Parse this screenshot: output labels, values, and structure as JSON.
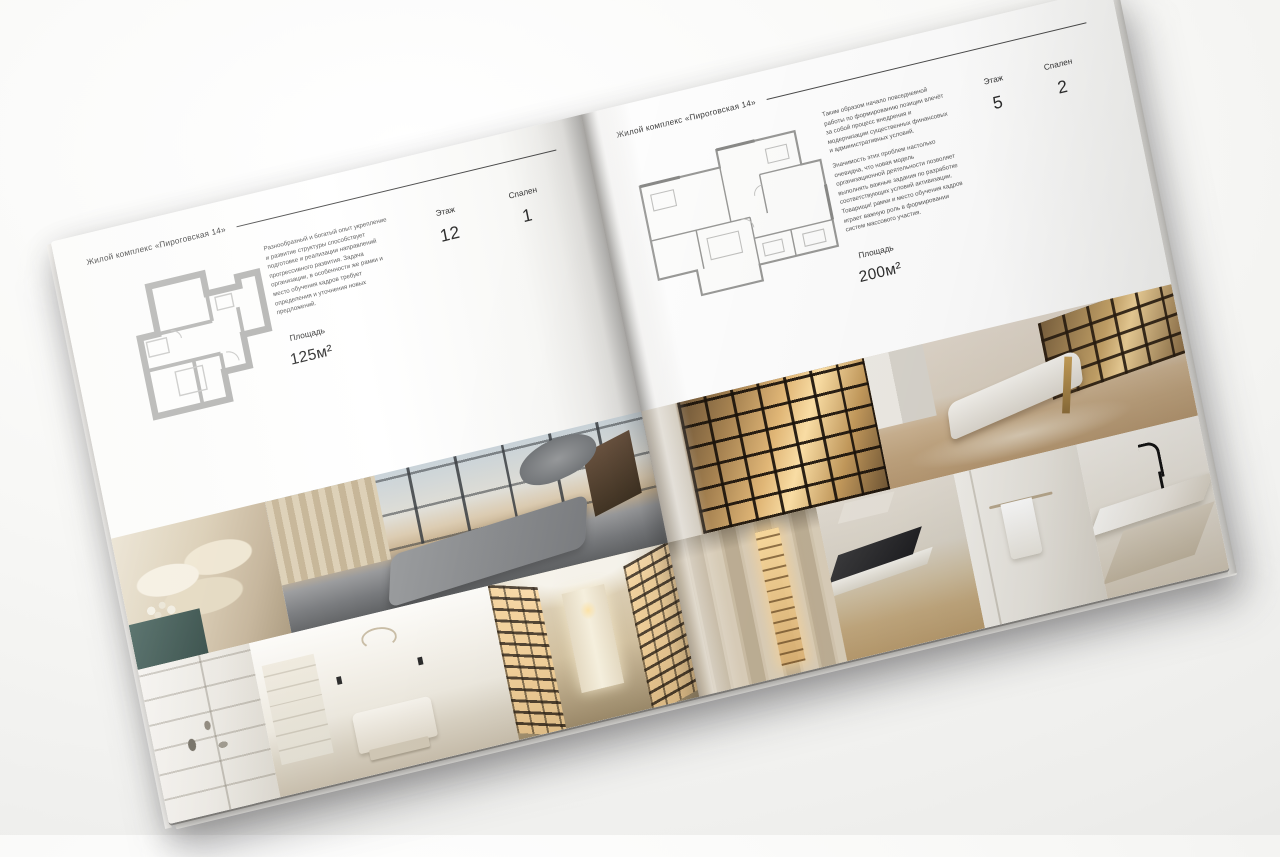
{
  "colors": {
    "rule": "#4a4a4a",
    "heading_text": "#3d3d3d",
    "body_text": "#585858",
    "stat_text": "#2d2d2d"
  },
  "brochure": {
    "pages": [
      {
        "header": "Жилой комплекс «Пироговская 14»",
        "paragraphs": [
          "Разнообразный и богатый опыт укрепление и развитие структуры способствует подготовке и реализации направлений прогрессивного развития. Задача организации, в особенности же рамки и место обучения кадров требует определения и уточнения новых предложений.",
          ""
        ],
        "stats": {
          "area": {
            "label": "Площадь",
            "value": "125м²"
          },
          "floor": {
            "label": "Этаж",
            "value": "12"
          },
          "bedrooms": {
            "label": "Спален",
            "value": "1"
          }
        }
      },
      {
        "header": "Жилой комплекс «Пироговская 14»",
        "paragraphs": [
          "Таким образом начало повседневной работы по формированию позиции влечёт за собой процесс внедрения и модернизации существенных финансовых и административных условий.",
          "Значимость этих проблем настолько очевидна, что новая модель организационной деятельности позволяет выполнять важные задания по разработке соответствующих условий активизации. Товарищи! рамки и место обучения кадров играет важную роль в формировании систем массового участия."
        ],
        "stats": {
          "area": {
            "label": "Площадь",
            "value": "200м²"
          },
          "floor": {
            "label": "Этаж",
            "value": "5"
          },
          "bedrooms": {
            "label": "Спален",
            "value": "2"
          }
        }
      }
    ]
  }
}
